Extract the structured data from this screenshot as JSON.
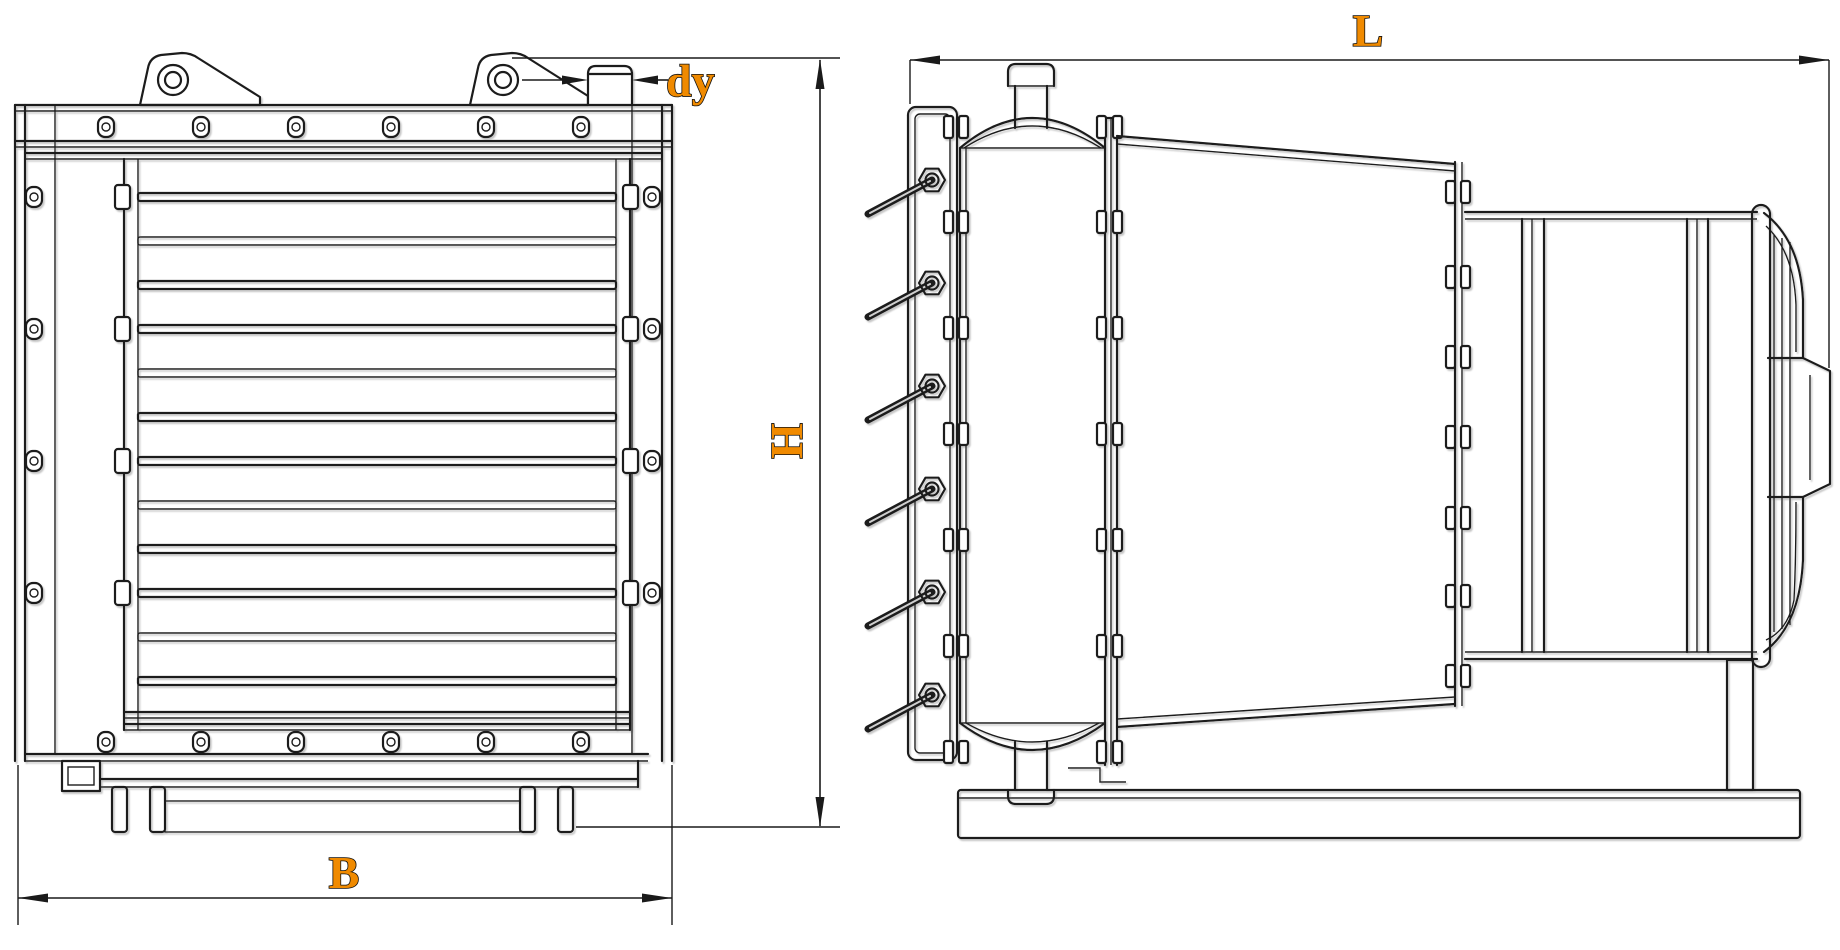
{
  "drawing": {
    "kind": "technical-engineering-drawing",
    "dimension_labels": {
      "length": "L",
      "height": "H",
      "width": "B",
      "nozzle_diameter": "dy"
    }
  },
  "colors": {
    "background": "#ffffff",
    "line": "#1a1a1a",
    "accent_label": "#f08a00"
  }
}
